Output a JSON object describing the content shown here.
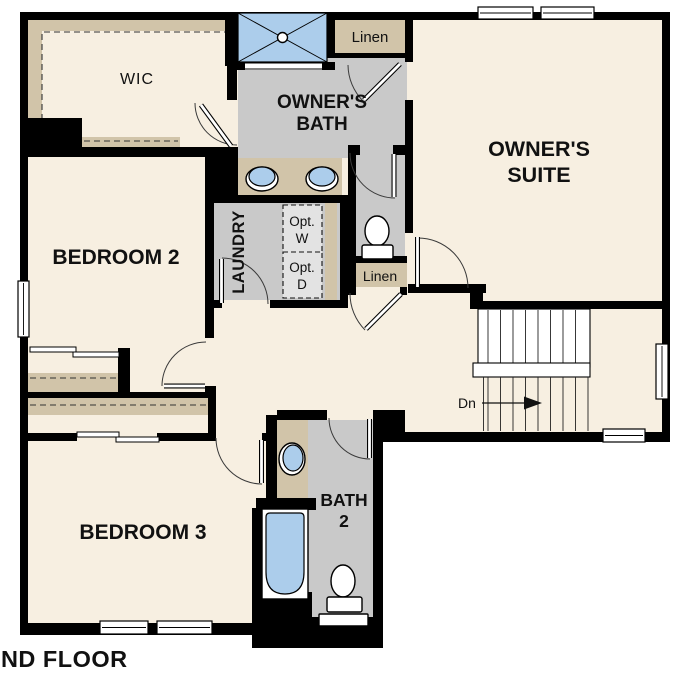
{
  "title": "SECOND FLOOR",
  "colors": {
    "floor": "#f7efe1",
    "wet": "#c9c9c9",
    "tan": "#d1c4a9",
    "blue": "#accdeb",
    "wall": "#000000",
    "optbox": "#e3e3e3",
    "outside": "#ffffff"
  },
  "rooms": {
    "wic": {
      "label": "WIC"
    },
    "owners_bath": {
      "line1": "OWNER'S",
      "line2": "BATH"
    },
    "owners_suite": {
      "line1": "OWNER'S",
      "line2": "SUITE"
    },
    "bedroom2": {
      "label": "BEDROOM 2"
    },
    "bedroom3": {
      "label": "BEDROOM 3"
    },
    "laundry": {
      "label": "LAUNDRY"
    },
    "bath2": {
      "line1": "BATH",
      "line2": "2"
    },
    "linen_upper": {
      "label": "Linen"
    },
    "linen_lower": {
      "label": "Linen"
    },
    "opt_washer": {
      "line1": "Opt.",
      "line2": "W"
    },
    "opt_dryer": {
      "line1": "Opt.",
      "line2": "D"
    }
  },
  "stairs": {
    "down_label": "Dn"
  }
}
